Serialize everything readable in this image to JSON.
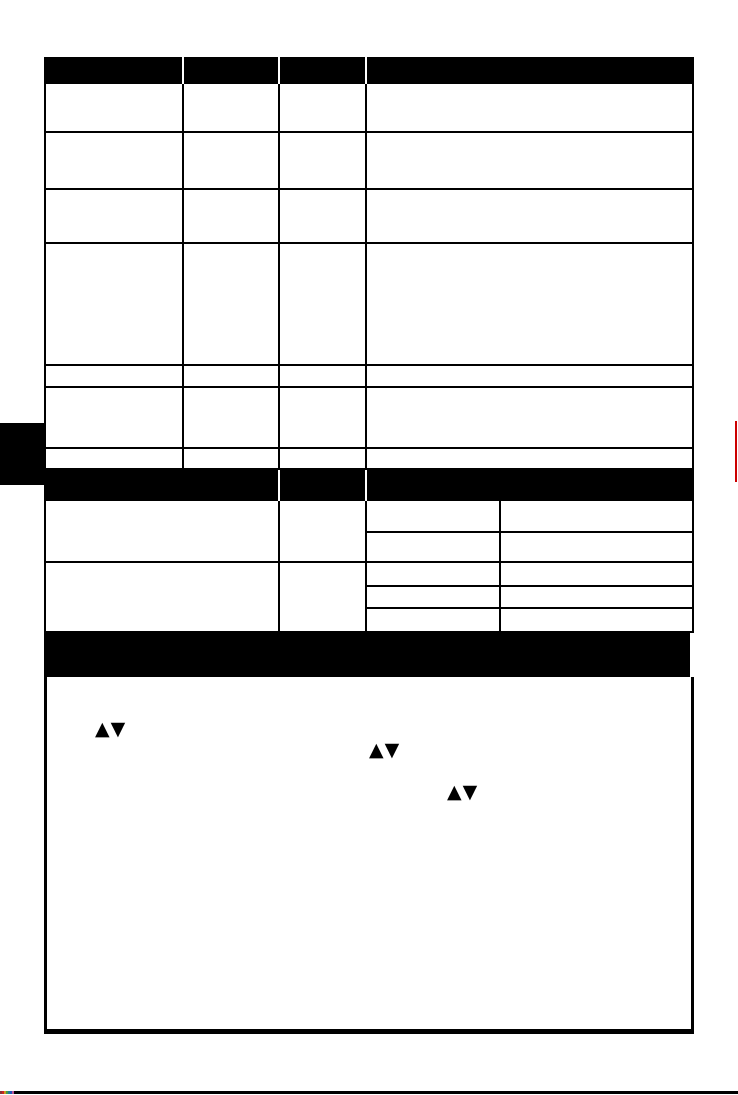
{
  "page": {
    "background": "#ffffff",
    "ink": "#000000"
  },
  "table1": {
    "header": [
      "",
      "",
      "",
      ""
    ],
    "rows": [
      [
        "",
        "",
        "",
        ""
      ],
      [
        "",
        "",
        "",
        ""
      ],
      [
        "",
        "",
        "",
        ""
      ],
      [
        "",
        "",
        "",
        ""
      ],
      [
        "",
        "",
        "",
        ""
      ],
      [
        "",
        "",
        "",
        ""
      ],
      [
        "",
        "",
        "",
        ""
      ]
    ]
  },
  "table2": {
    "header": [
      "",
      "",
      ""
    ],
    "groups": [
      {
        "col1": "",
        "col2": "",
        "subrows": [
          [
            "",
            ""
          ],
          [
            "",
            ""
          ]
        ]
      },
      {
        "col1": "",
        "col2": "",
        "subrows": [
          [
            "",
            ""
          ],
          [
            "",
            ""
          ],
          [
            "",
            ""
          ]
        ]
      }
    ]
  },
  "section_bar": {
    "title": ""
  },
  "content_box": {
    "arrow_pairs": [
      {
        "glyph": "▲▼"
      },
      {
        "glyph": "▲▼"
      },
      {
        "glyph": "▲▼"
      }
    ]
  },
  "colors": {
    "edge_marker_red": "#cc0000",
    "calibration_chips": [
      "#883333",
      "#cc2222",
      "#cc9922",
      "#449944",
      "#227799",
      "#2255bb",
      "#bb5599"
    ]
  }
}
